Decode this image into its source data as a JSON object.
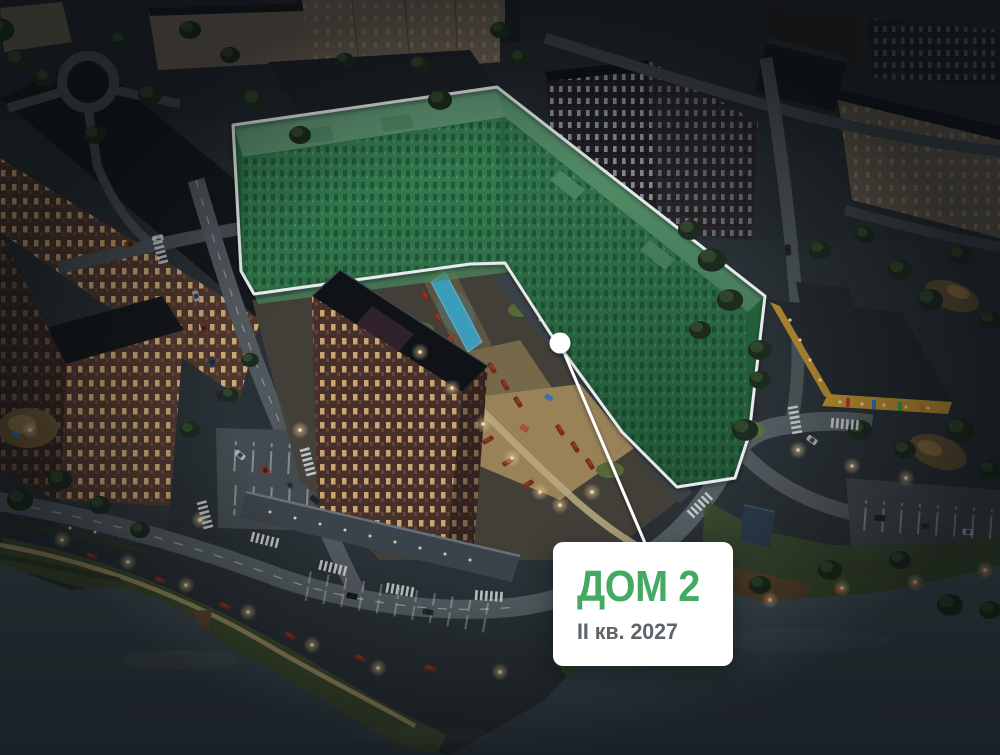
{
  "card": {
    "title": "ДОМ 2",
    "subtitle": "II кв. 2027",
    "title_color": "#43A963",
    "subtitle_color": "#5F6468",
    "background_color": "#FFFFFF"
  },
  "overlay": {
    "polygon_points": "233,125 497,87 765,296 749,435 735,478 677,487 622,432 550,333 505,263 470,264 254,294 241,271",
    "fill_color": "#2E7A49",
    "outline_color": "#FFFFFF",
    "marker": {
      "cx": 560,
      "cy": 343,
      "r": 10.5
    },
    "callout": {
      "x1": 560,
      "y1": 343,
      "x2": 645,
      "y2": 543
    }
  },
  "palette": {
    "water": "#3E4B52",
    "roads": "#596065",
    "night_ground": "#2B3136",
    "brick_buildings": "#54382E",
    "lit_windows_warm": "#FFD28C",
    "highlight_facade_green": "#3A8A55",
    "highlight_roof_green": "#6AA67E",
    "pool_blue": "#3FA9CB",
    "lamp_glow": "#FFDF9E",
    "kindergarten_yellow": "#C2932F"
  }
}
